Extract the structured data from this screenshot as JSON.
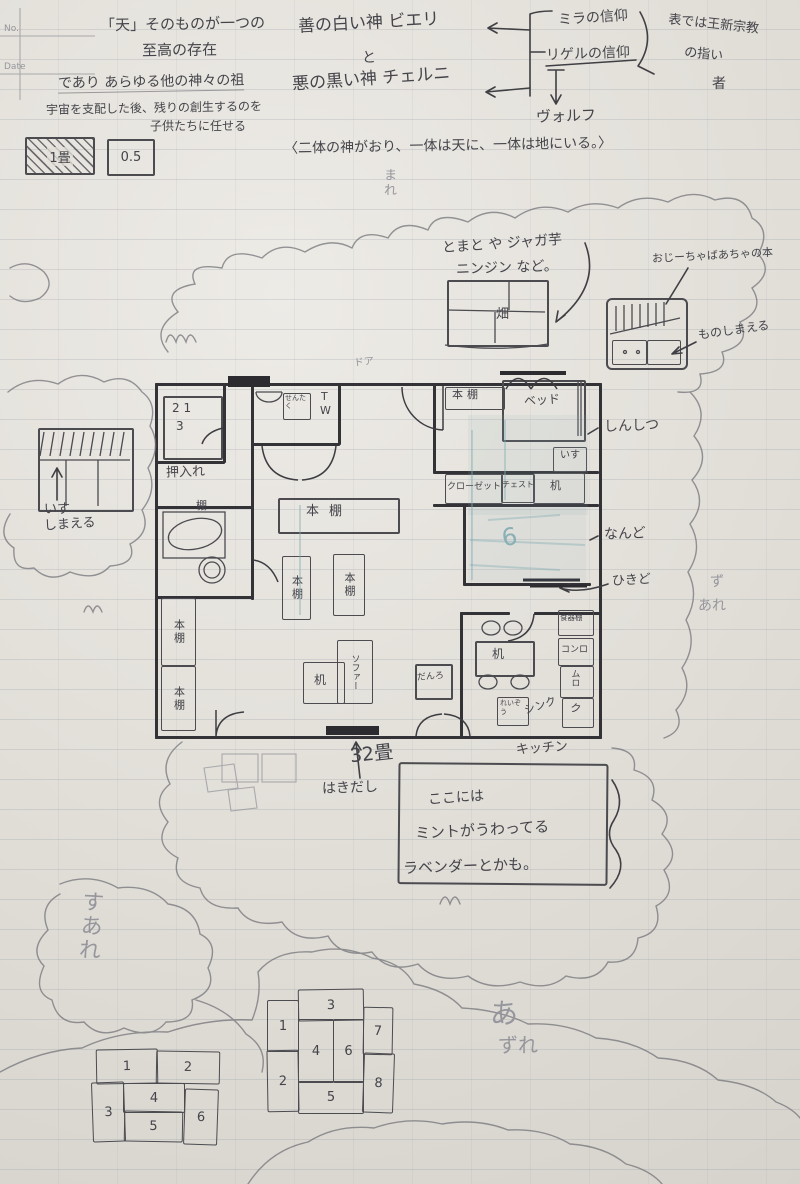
{
  "notebook": {
    "no": "No.",
    "date": "Date"
  },
  "lore": {
    "heaven1": "「天」そのものが一つの",
    "heaven2": "至高の存在",
    "heaven3": "であり あらゆる他の神々の祖",
    "heaven4": "宇宙を支配した後、残りの創生するのを",
    "heaven5": "子供たちに任せる",
    "god_white": "善の白い神 ビエリ",
    "and": "と",
    "god_black": "悪の黒い神 チェルニ",
    "faith_mira": "ミラの信仰",
    "faith_rigel": "リゲルの信仰",
    "leader1": "表では王新宗教",
    "leader2": "の指い",
    "leader3": "者",
    "volf": "ヴォルフ",
    "two_gods": "〈二体の神がおり、一体は天に、一体は地にいる。〉"
  },
  "legend": {
    "one": "1畳",
    "half": "0.5"
  },
  "garden": {
    "crops1": "とまと や ジャガ芋",
    "crops2": "ニンジン など。",
    "field": "畑"
  },
  "cabinet": {
    "books": "おじーちゃばあちゃの本",
    "store": "ものしまえる"
  },
  "side_table": {
    "chair": "いす",
    "store": "しまえる"
  },
  "plan": {
    "room_num1": "2 1",
    "room_num2": "3",
    "oshiire": "押入れ",
    "shelf": "棚",
    "laundry": "せんたく",
    "toilet_t": "T",
    "toilet_w": "W",
    "bookshelf": "本棚",
    "bed": "ベッド",
    "bedroom": "しんしつ",
    "chair": "いす",
    "closet": "クローゼット",
    "chest": "チェスト",
    "desk": "机",
    "nando": "なんど",
    "nando_size": "6",
    "hikido": "ひきど",
    "sofa": "ソファー",
    "fireplace": "だんろ",
    "dish_shelf": "食器棚",
    "stove": "コンロ",
    "muro": "ムロ",
    "ku": "ク",
    "sink": "シンク",
    "fridge": "れいぞう",
    "kitchen": "キッチン",
    "tatami32": "32畳",
    "hakidashi": "はきだし",
    "door": "ドア"
  },
  "mint_note": {
    "l1": "ここには",
    "l2": "ミントがうわってる",
    "l3": "ラベンダーとかも。"
  },
  "scribbles": {
    "top": "まれ",
    "right1": "ず",
    "right2": "あれ",
    "left": "すあれ",
    "bottom1": "あ",
    "bottom2": "ずれ"
  },
  "grid_left": {
    "n1": "1",
    "n2": "2",
    "n3": "3",
    "n4": "4",
    "n5": "5",
    "n6": "6"
  },
  "grid_center": {
    "n1": "1",
    "n2": "2",
    "n3": "3",
    "n4": "4",
    "n5": "5",
    "n6": "6",
    "n7": "7",
    "n8": "8"
  }
}
